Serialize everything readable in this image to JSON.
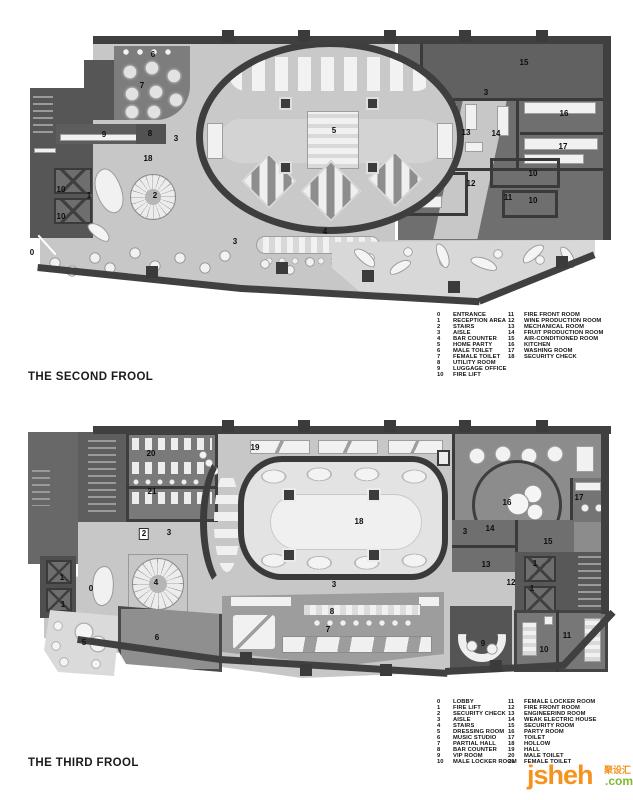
{
  "floor2": {
    "title": "THE SECOND FROOL",
    "legend": {
      "col1": [
        {
          "n": "0",
          "t": "ENTRANCE"
        },
        {
          "n": "1",
          "t": "RECEPTION AREA"
        },
        {
          "n": "2",
          "t": "STAIRS"
        },
        {
          "n": "3",
          "t": "AISLE"
        },
        {
          "n": "4",
          "t": "BAR COUNTER"
        },
        {
          "n": "5",
          "t": "HOME PARTY"
        },
        {
          "n": "6",
          "t": "MALE TOILET"
        },
        {
          "n": "7",
          "t": "FEMALE TOILET"
        },
        {
          "n": "8",
          "t": "UTILITY ROOM"
        },
        {
          "n": "9",
          "t": "LUGGAGE OFFICE"
        },
        {
          "n": "10",
          "t": "FIRE LIFT"
        }
      ],
      "col2": [
        {
          "n": "11",
          "t": "FIRE FRONT ROOM"
        },
        {
          "n": "12",
          "t": "WINE PRODUCTION ROOM"
        },
        {
          "n": "13",
          "t": "MECHANICAL ROOM"
        },
        {
          "n": "14",
          "t": "FRUIT PRODUCTION ROOM"
        },
        {
          "n": "15",
          "t": "AIR-CONDITIONED ROOM"
        },
        {
          "n": "16",
          "t": "KITCHEN"
        },
        {
          "n": "17",
          "t": "WASHING ROOM"
        },
        {
          "n": "18",
          "t": "SECURITY CHECK"
        }
      ]
    },
    "labels": [
      {
        "t": "6",
        "x": 153,
        "y": 55
      },
      {
        "t": "7",
        "x": 142,
        "y": 86
      },
      {
        "t": "9",
        "x": 104,
        "y": 135
      },
      {
        "t": "8",
        "x": 150,
        "y": 134
      },
      {
        "t": "3",
        "x": 176,
        "y": 139
      },
      {
        "t": "18",
        "x": 148,
        "y": 159
      },
      {
        "t": "15",
        "x": 524,
        "y": 63
      },
      {
        "t": "3",
        "x": 486,
        "y": 93
      },
      {
        "t": "13",
        "x": 466,
        "y": 133
      },
      {
        "t": "14",
        "x": 496,
        "y": 134
      },
      {
        "t": "16",
        "x": 564,
        "y": 114
      },
      {
        "t": "17",
        "x": 563,
        "y": 147
      },
      {
        "t": "5",
        "x": 334,
        "y": 131
      },
      {
        "t": "10",
        "x": 61,
        "y": 190
      },
      {
        "t": "10",
        "x": 61,
        "y": 217
      },
      {
        "t": "1",
        "x": 89,
        "y": 196
      },
      {
        "t": "2",
        "x": 155,
        "y": 196
      },
      {
        "t": "0",
        "x": 32,
        "y": 253
      },
      {
        "t": "3",
        "x": 235,
        "y": 242
      },
      {
        "t": "4",
        "x": 325,
        "y": 232
      },
      {
        "t": "12",
        "x": 471,
        "y": 184
      },
      {
        "t": "10",
        "x": 533,
        "y": 174
      },
      {
        "t": "11",
        "x": 508,
        "y": 198
      },
      {
        "t": "10",
        "x": 533,
        "y": 201
      }
    ]
  },
  "floor3": {
    "title": "THE THIRD FROOL",
    "legend": {
      "col1": [
        {
          "n": "0",
          "t": "LOBBY"
        },
        {
          "n": "1",
          "t": "FIRE LIFT"
        },
        {
          "n": "2",
          "t": "SECURITY CHECK"
        },
        {
          "n": "3",
          "t": "AISLE"
        },
        {
          "n": "4",
          "t": "STAIRS"
        },
        {
          "n": "5",
          "t": "DRESSING ROOM"
        },
        {
          "n": "6",
          "t": "MUSIC STUDIO"
        },
        {
          "n": "7",
          "t": "PARTIAL HALL"
        },
        {
          "n": "8",
          "t": "BAR COUNTER"
        },
        {
          "n": "9",
          "t": "VIP ROOM"
        },
        {
          "n": "10",
          "t": "MALE LOCKER ROOM"
        }
      ],
      "col2": [
        {
          "n": "11",
          "t": "FEMALE LOCKER ROOM"
        },
        {
          "n": "12",
          "t": "FIRE FRONT ROOM"
        },
        {
          "n": "13",
          "t": "ENGINEERIND ROOM"
        },
        {
          "n": "14",
          "t": "WEAK ELECTRIC HOUSE"
        },
        {
          "n": "15",
          "t": "SECURITY ROOM"
        },
        {
          "n": "16",
          "t": "PARTY ROOM"
        },
        {
          "n": "17",
          "t": "TOILET"
        },
        {
          "n": "18",
          "t": "HOLLOW"
        },
        {
          "n": "19",
          "t": "HALL"
        },
        {
          "n": "20",
          "t": "MALE TOILET"
        },
        {
          "n": "21",
          "t": "FEMALE TOILET"
        }
      ]
    },
    "labels": [
      {
        "t": "20",
        "x": 151,
        "y": 454
      },
      {
        "t": "21",
        "x": 152,
        "y": 492
      },
      {
        "t": "19",
        "x": 255,
        "y": 448
      },
      {
        "t": "2",
        "x": 144,
        "y": 534,
        "b": true
      },
      {
        "t": "3",
        "x": 169,
        "y": 533
      },
      {
        "t": "18",
        "x": 359,
        "y": 522
      },
      {
        "t": "3",
        "x": 465,
        "y": 532
      },
      {
        "t": "16",
        "x": 507,
        "y": 503
      },
      {
        "t": "17",
        "x": 579,
        "y": 498
      },
      {
        "t": "14",
        "x": 490,
        "y": 529
      },
      {
        "t": "15",
        "x": 548,
        "y": 542
      },
      {
        "t": "13",
        "x": 486,
        "y": 565
      },
      {
        "t": "1",
        "x": 535,
        "y": 564
      },
      {
        "t": "12",
        "x": 511,
        "y": 583
      },
      {
        "t": "1",
        "x": 532,
        "y": 589
      },
      {
        "t": "1",
        "x": 62,
        "y": 578
      },
      {
        "t": "1",
        "x": 63,
        "y": 605
      },
      {
        "t": "0",
        "x": 91,
        "y": 589
      },
      {
        "t": "4",
        "x": 156,
        "y": 583
      },
      {
        "t": "5",
        "x": 84,
        "y": 643
      },
      {
        "t": "6",
        "x": 157,
        "y": 638
      },
      {
        "t": "3",
        "x": 334,
        "y": 585
      },
      {
        "t": "8",
        "x": 332,
        "y": 612
      },
      {
        "t": "7",
        "x": 328,
        "y": 630
      },
      {
        "t": "9",
        "x": 483,
        "y": 644
      },
      {
        "t": "10",
        "x": 544,
        "y": 650
      },
      {
        "t": "11",
        "x": 567,
        "y": 636
      }
    ]
  },
  "watermark": {
    "name": "jsheh",
    "suffix": ".com",
    "cn": "聚设汇",
    "orange": "#f6921e",
    "green": "#7fb832"
  }
}
